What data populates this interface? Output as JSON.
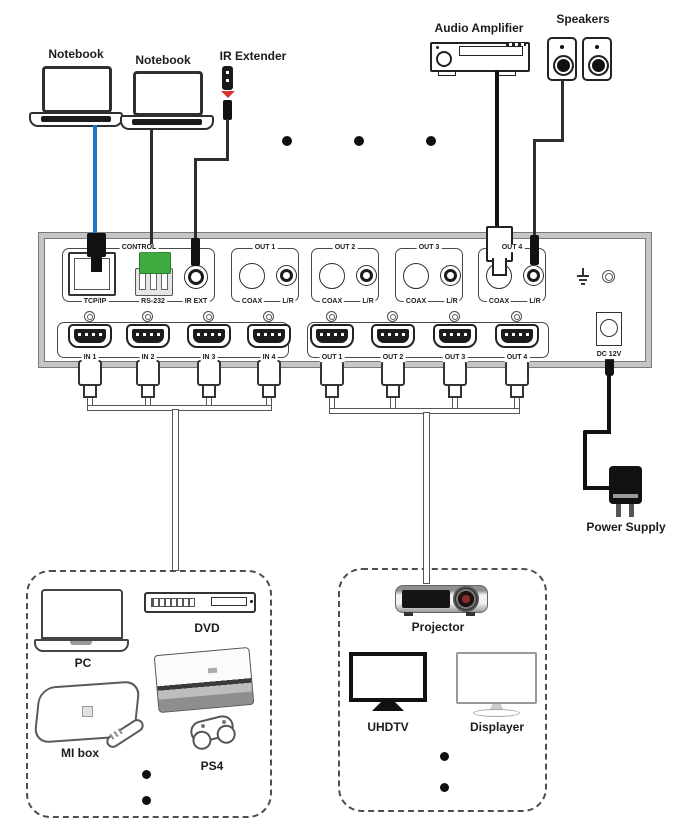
{
  "top_devices": {
    "notebook_1": "Notebook",
    "notebook_2": "Notebook",
    "ir_extender": "IR Extender",
    "audio_amplifier": "Audio Amplifier",
    "speakers": "Speakers"
  },
  "matrix_panel": {
    "control_group": "CONTROL",
    "tcp_ip": "TCP/IP",
    "rs_232": "RS-232",
    "ir_ext": "IR EXT",
    "out_groups": [
      {
        "name": "OUT 1",
        "coax": "COAX",
        "lr": "L/R"
      },
      {
        "name": "OUT 2",
        "coax": "COAX",
        "lr": "L/R"
      },
      {
        "name": "OUT 3",
        "coax": "COAX",
        "lr": "L/R"
      },
      {
        "name": "OUT 4",
        "coax": "COAX",
        "lr": "L/R"
      }
    ],
    "hdmi_in": [
      "IN 1",
      "IN 2",
      "IN 3",
      "IN 4"
    ],
    "hdmi_out": [
      "OUT 1",
      "OUT 2",
      "OUT 3",
      "OUT 4"
    ],
    "dc_power": "DC 12V"
  },
  "power_supply": "Power Supply",
  "source_devices": {
    "pc": "PC",
    "dvd": "DVD",
    "mi_box": "MI box",
    "ps4": "PS4"
  },
  "display_devices": {
    "projector": "Projector",
    "uhdtv": "UHDTV",
    "displayer": "Displayer"
  },
  "colors": {
    "ethernet_cable_blue": "#1878c8",
    "rs232_connector_green": "#3faa3f",
    "ir_extender_red": "#d83434",
    "panel_frame_gray": "#c6c6c6"
  }
}
